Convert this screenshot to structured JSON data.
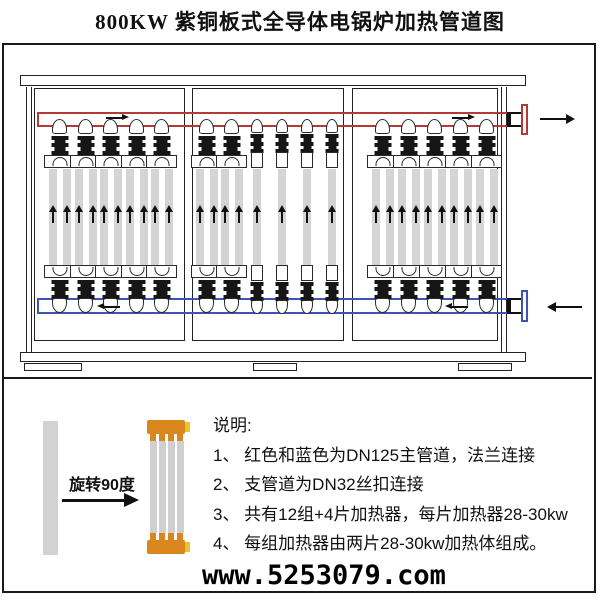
{
  "title": "800KW 紫铜板式全导体电锅炉加热管道图",
  "watermark": "www.5253079.com",
  "colors": {
    "supply_pipe_red": "#b23b35",
    "return_pipe_blue": "#3c54b4",
    "tube_gray": "#d4d4d4",
    "heater_cap_orange": "#d9861f",
    "heater_tab_yellow": "#ecc12c"
  },
  "boiler": {
    "panels": [
      {
        "assemblies": [
          "group",
          "group",
          "group",
          "group",
          "group"
        ]
      },
      {
        "assemblies": [
          "group",
          "group",
          "single",
          "single",
          "single",
          "single"
        ]
      },
      {
        "assemblies": [
          "group",
          "group",
          "group",
          "group",
          "group"
        ]
      }
    ],
    "supply_outlet_direction": "right",
    "return_inlet_direction": "left"
  },
  "legend": {
    "rotate_label": "旋转90度",
    "notes_title": "说明:",
    "notes": [
      "1、 红色和蓝色为DN125主管道，法兰连接",
      "2、 支管道为DN32丝扣连接",
      "3、 共有12组+4片加热器，每片加热器28-30kw",
      "4、 每组加热器由两片28-30kw加热体组成。"
    ]
  }
}
